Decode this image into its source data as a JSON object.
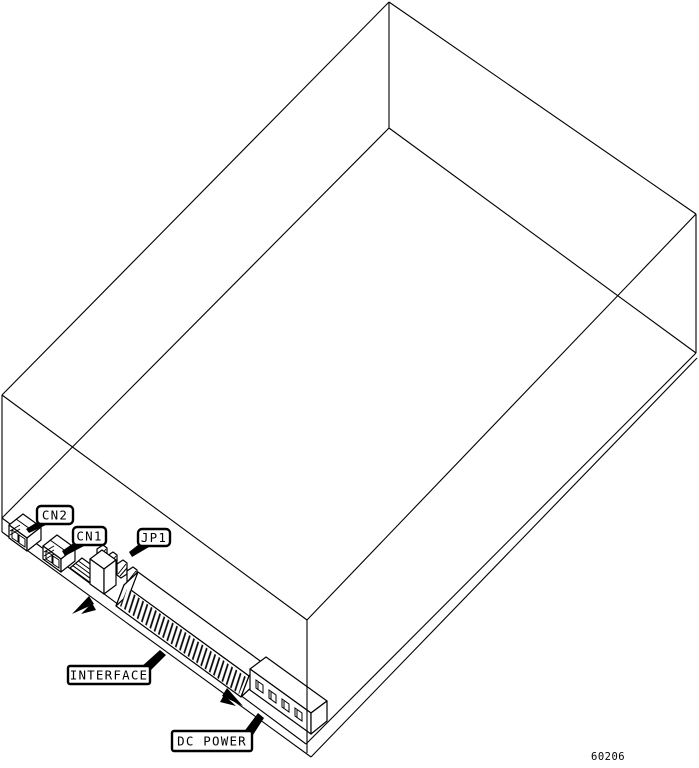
{
  "figure": {
    "number": "60206",
    "callouts": [
      {
        "id": "cn2",
        "label": "CN2"
      },
      {
        "id": "cn1",
        "label": "CN1"
      },
      {
        "id": "jp1",
        "label": "JP1"
      },
      {
        "id": "interface",
        "label": "INTERFACE"
      },
      {
        "id": "dc-power",
        "label": "DC POWER"
      }
    ],
    "colors": {
      "line": "#000000",
      "background": "#ffffff"
    }
  }
}
